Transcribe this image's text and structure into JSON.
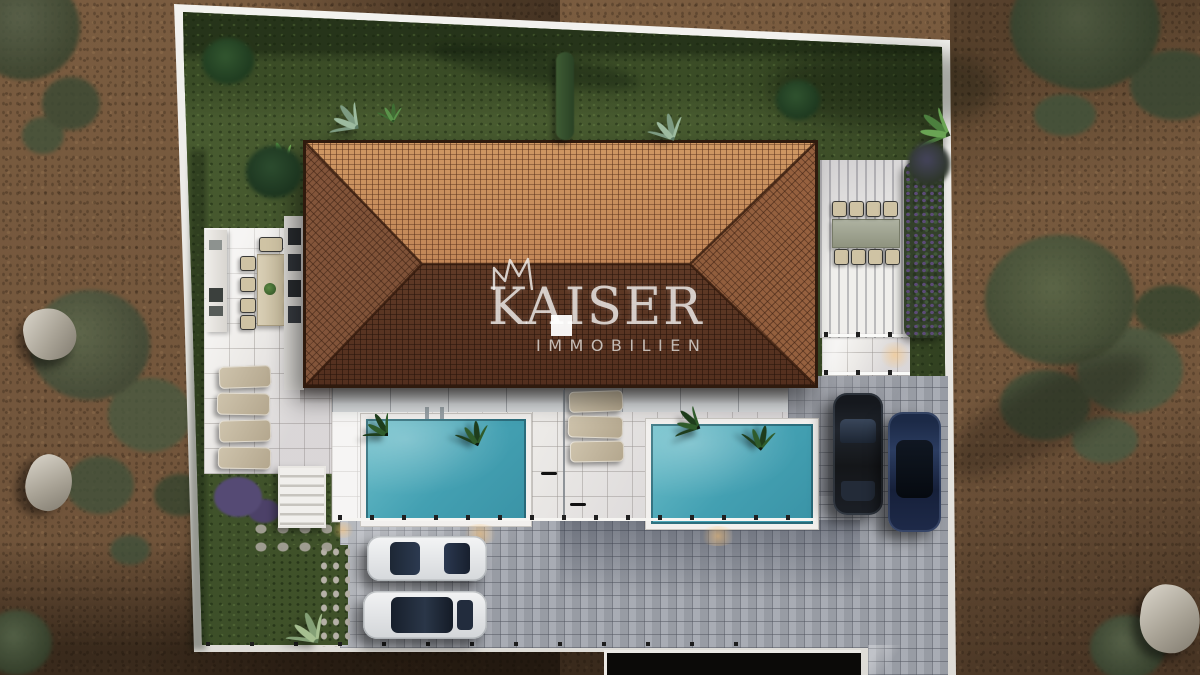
{
  "watermark": {
    "brand": "KAISER",
    "subtitle": "IMMOBILIEN",
    "icon": "crown-icon"
  },
  "scene": {
    "view": "top-down aerial 3D architectural render",
    "subject": "villa plot with hip tiled roof, two swimming pools, pergola dining terrace, sun loungers, parking court and landscaped garden surrounded by bare earth",
    "counts": {
      "pools": 2,
      "white_cars": 2,
      "dark_cars": 2,
      "terrace_loungers": 4,
      "poolside_loungers": 3,
      "dining_sets": 2
    },
    "palette": {
      "roof_tile_light": "#c08a58",
      "roof_tile_dark": "#5e3d2a",
      "pool_water": "#4aa5b6",
      "lawn": "#46582e",
      "dirt": "#7d5f42",
      "deck_tile": "#edebe8",
      "pavers": "#a2a6ae",
      "boundary_wall": "#eeedea"
    }
  }
}
